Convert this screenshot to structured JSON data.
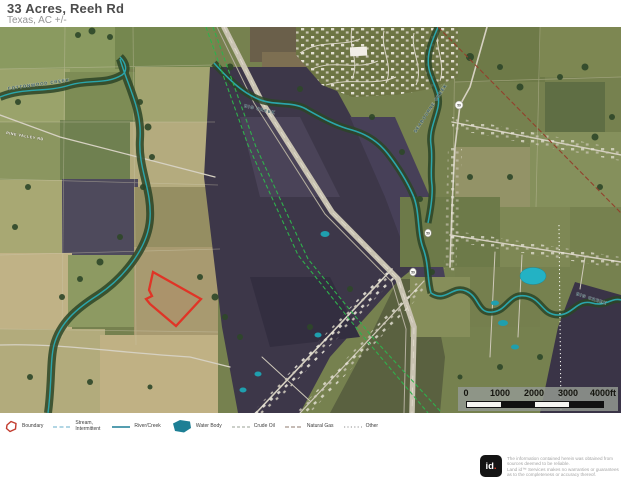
{
  "header": {
    "title": "33 Acres, Reeh Rd",
    "subtitle": "Texas,  AC +/-"
  },
  "map": {
    "labels": {
      "cottonwood_creek": "COTTONWOOD CREEK",
      "big_creek_upper": "BIG CREEK",
      "seabourne_creek": "SEABOURNE CREEK",
      "big_creek_lower": "BIG CREEK",
      "pine_valley_rd": "PINE VALLEY RD"
    },
    "route_shields": [
      "59",
      "59",
      "59"
    ],
    "scale_bar": {
      "ticks": [
        "0",
        "1000",
        "2000",
        "3000"
      ],
      "end": "4000ft"
    },
    "colors": {
      "boundary": "#e03426",
      "river_creek": "#2ba6ac",
      "water_body": "#23b2c4",
      "crude_oil_line": "#2fb14c",
      "natural_gas_line": "#93402c",
      "other_line": "#ffffff"
    }
  },
  "legend": {
    "items": [
      {
        "label": "Boundary"
      },
      {
        "label": "Stream, Intermittent"
      },
      {
        "label": "River/Creek"
      },
      {
        "label": "Water Body"
      },
      {
        "label": "Crude Oil"
      },
      {
        "label": "Natural Gas"
      },
      {
        "label": "Other"
      }
    ]
  },
  "footer": {
    "logo": {
      "text": "id",
      "dot": "."
    },
    "disclaimer_lines": [
      "The information contained herein was obtained from",
      "sources deemed to be reliable.",
      "Land id™ Services makes no warranties or guarantees",
      "as to the completeness or accuracy thereof."
    ]
  }
}
